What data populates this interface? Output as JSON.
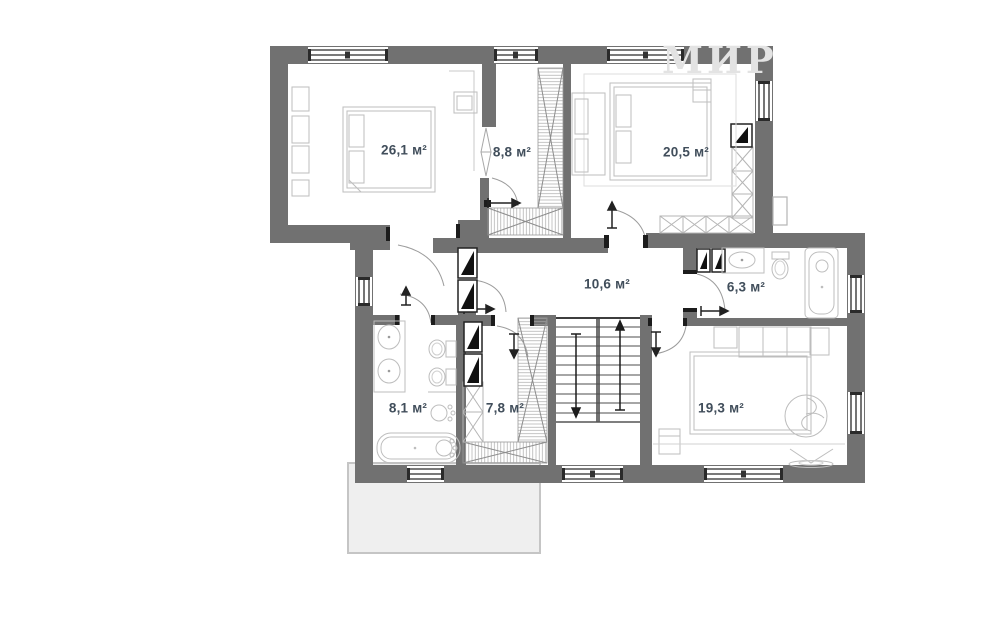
{
  "watermark": "МИР",
  "rooms": [
    {
      "name": "bedroom-large",
      "label": "26,1 м²"
    },
    {
      "name": "wardrobe-top",
      "label": "8,8 м²"
    },
    {
      "name": "bedroom-right",
      "label": "20,5 м²"
    },
    {
      "name": "hallway",
      "label": "10,6 м²"
    },
    {
      "name": "bathroom-right",
      "label": "6,3 м²"
    },
    {
      "name": "bathroom-left",
      "label": "8,1 м²"
    },
    {
      "name": "wardrobe-bottom",
      "label": "7,8 м²"
    },
    {
      "name": "bedroom-bottom",
      "label": "19,3 м²"
    }
  ],
  "colors": {
    "wall": "#717171",
    "label_text": "#414e5b",
    "furniture_line": "#bdbdbd",
    "terrace_fill": "#efefef",
    "terrace_border": "#c5c5c5",
    "watermark": "#e3e3e3"
  }
}
